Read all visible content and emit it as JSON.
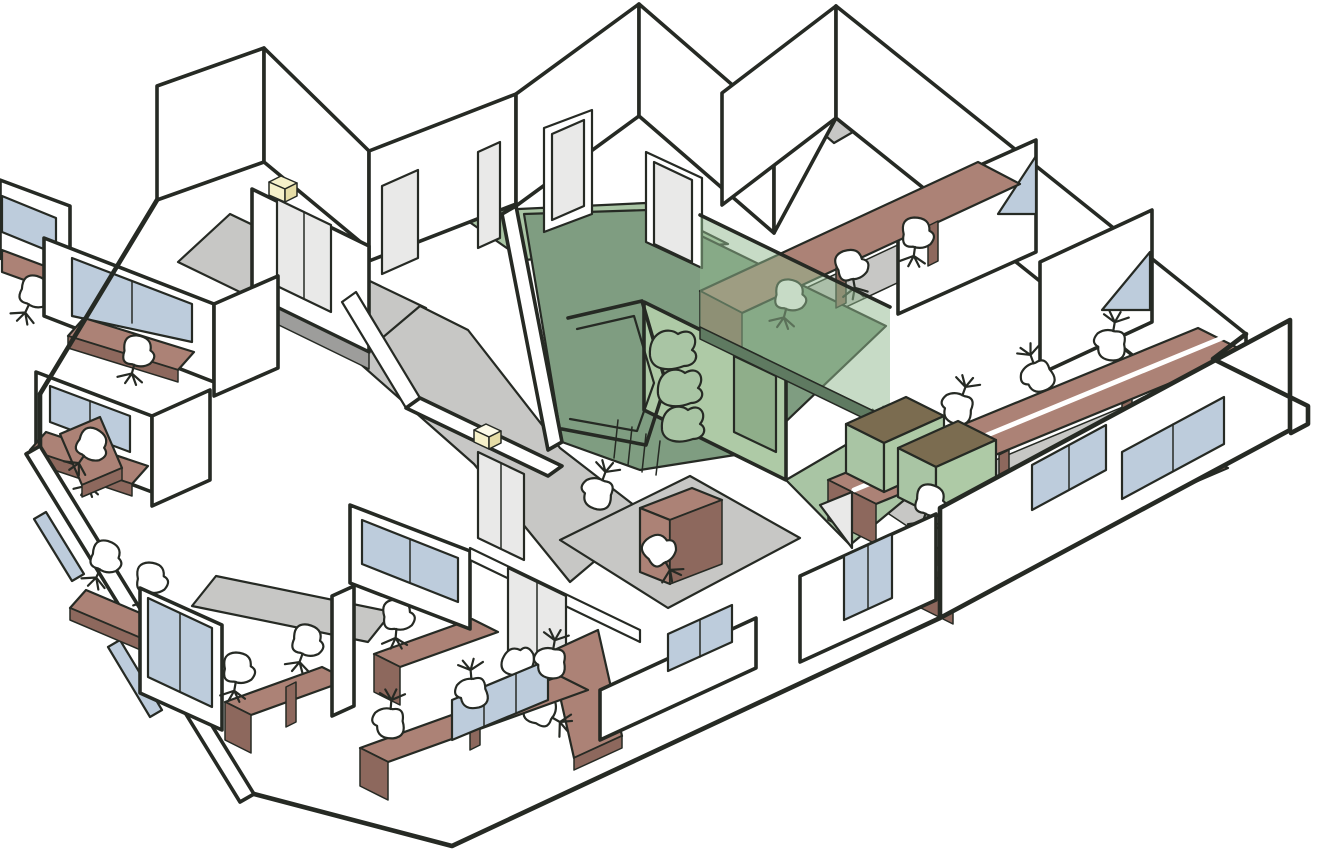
{
  "colors": {
    "line": "#262a24",
    "wall": "#ffffff",
    "floor_gray": "#c7c7c5",
    "floor_gray_dark": "#9d9d9b",
    "green_floor": "#7f9d81",
    "green_floor_light": "#a9c5a4",
    "green_wall": "#aecaa6",
    "green_glass": "#8fb78d",
    "green_base": "#5f7a61",
    "green_door": "#8fae8a",
    "desk": "#ac8276",
    "desk_side": "#8d685d",
    "desk_olive": "#7b6c50",
    "window_blue": "#bdccdc",
    "door_gray": "#e9e9e8",
    "yellow": "#f6f1ca",
    "yellow_dark": "#e6dda6",
    "white_stripe": "#ffffff"
  }
}
